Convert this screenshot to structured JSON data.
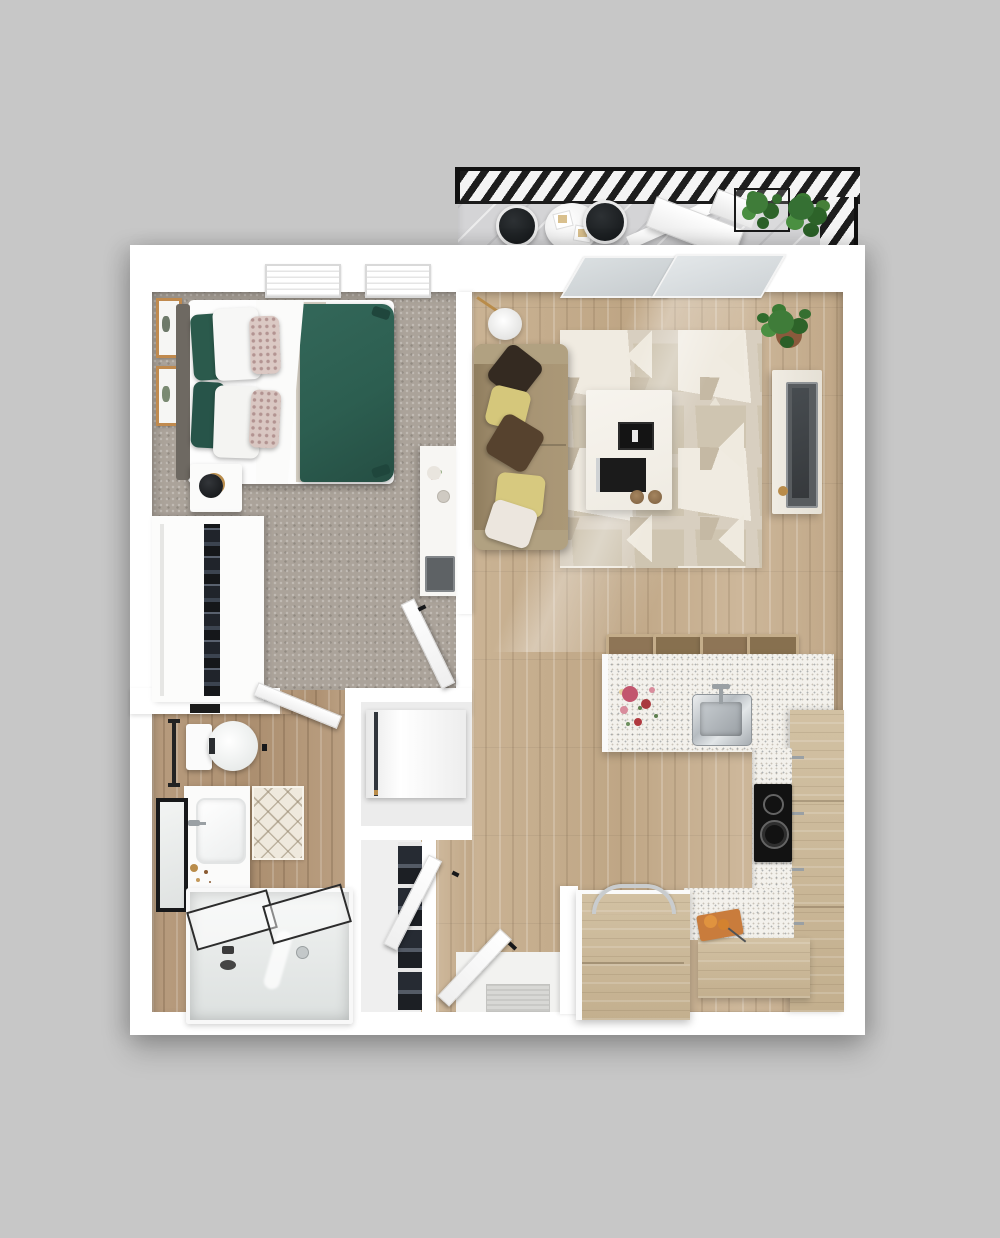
{
  "image_type": "3d-apartment-floor-plan-top-view",
  "title_text_visible": "",
  "colors": {
    "background": "#c7c7c7",
    "wall": "#ffffff",
    "carpet": "#aba39a",
    "wood": "#c6ae8f",
    "bathWood": "#b3977a",
    "balconyFloor": "#d4d4d6",
    "railing": "#1d1d1d",
    "duvet": "#2c5e50",
    "pillowGreen": "#2b5a4c",
    "pillowYellow": "#d5c77b",
    "pillowBrown": "#56422e",
    "pillowDark": "#342a21",
    "couch": "#a59272",
    "rugBase": "#d8cfc0",
    "rugLight": "#efeadf",
    "rugTan": "#c5b9a4",
    "counter": "#f3f1ec",
    "cabinet": "#cdbb9d",
    "stool": "#8e7556",
    "cooktop": "#121212",
    "steel": "#b6bcc1",
    "glass": "#d3d8da",
    "plant": "#3f7c39",
    "plantDark": "#2d6329",
    "pot": "#8a5a3c",
    "gold": "#b98c4a",
    "matCream": "#efe9dd",
    "black": "#17181a"
  },
  "scene": {
    "balcony": {
      "label": "balcony",
      "items": [
        "hatched-railing",
        "plank-deck",
        "bistro-table",
        "cafe-chair",
        "cafe-chair",
        "lounge-chair",
        "potted-plant",
        "potted-plant",
        "wire-planter"
      ]
    },
    "bedroom": {
      "label": "bedroom",
      "items": [
        "double-bed",
        "green-duvet",
        "headboard",
        "green-pillows",
        "white-pillows",
        "floral-accent-pillows",
        "throw-blanket",
        "nightstand",
        "table-lamp",
        "wall-art-frame",
        "wall-art-frame",
        "wardrobe-with-clothes",
        "desk",
        "laptop",
        "window",
        "window",
        "bedroom-door"
      ]
    },
    "bathroom": {
      "label": "bathroom",
      "items": [
        "toilet",
        "towel-bar",
        "wall-shelf",
        "vanity-sink",
        "faucet",
        "framed-mirror",
        "diamond-bath-mat",
        "bathtub",
        "sliding-glass-shower-doors",
        "tub-faucet",
        "bathroom-door"
      ]
    },
    "hallway": {
      "label": "hallway-entry",
      "items": [
        "washer-dryer",
        "utility-shelving",
        "closet-door",
        "entry-door",
        "doormat",
        "entry-landing"
      ]
    },
    "living_room": {
      "label": "living-room",
      "items": [
        "sofa",
        "throw-pillow-dark",
        "throw-pillow-yellow",
        "throw-pillow-brown",
        "throw-pillow-yellow",
        "throw-pillow-white",
        "floor-lamp",
        "geometric-area-rug",
        "coffee-table",
        "books",
        "coasters",
        "tv-console",
        "television",
        "potted-plant",
        "sliding-balcony-door",
        "sunlight-glare"
      ]
    },
    "kitchen": {
      "label": "kitchen",
      "items": [
        "island-counter",
        "stainless-sink",
        "faucet",
        "bar-stool",
        "bar-stool",
        "bar-stool",
        "bar-stool",
        "flower-arrangement",
        "tall-cabinet",
        "wall-cabinet-run",
        "black-cooktop",
        "speckled-counter",
        "lower-cabinet-with-arc-handle",
        "cutting-board-with-bread",
        "cabinet-handles"
      ]
    }
  },
  "counts": {
    "bar_stools": 4,
    "cafe_chairs": 2,
    "throw_pillows": 5,
    "wall_frames": 2,
    "bedroom_windows": 2,
    "balcony_plants": 2
  }
}
